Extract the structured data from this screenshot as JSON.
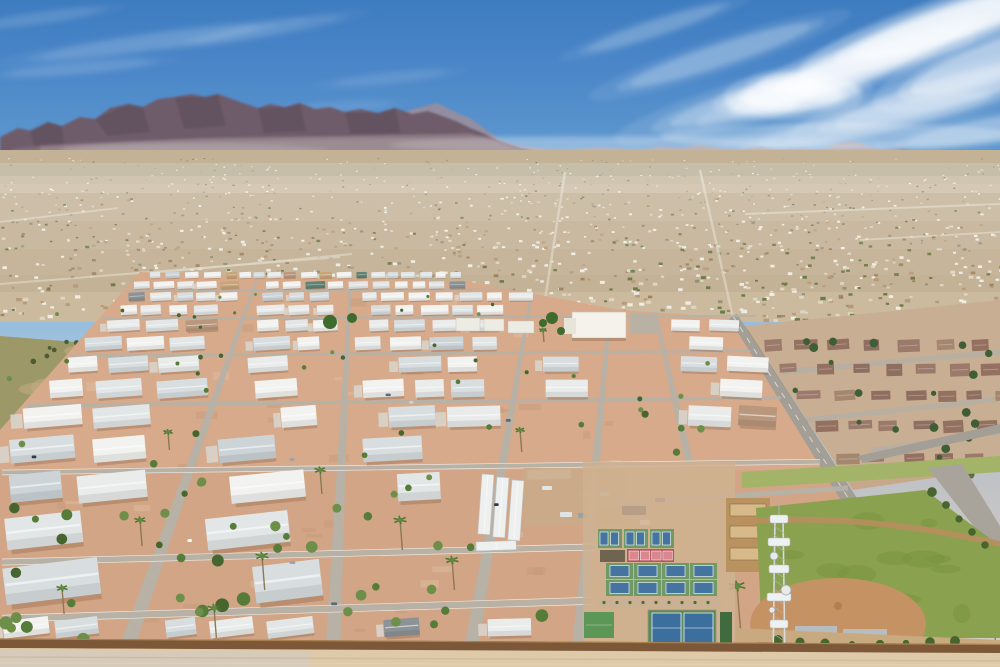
{
  "meta": {
    "width": 1000,
    "height": 667,
    "seed": 1317,
    "scene": "aerial-desert-mobile-home-park",
    "horizon_y": 168
  },
  "palette": {
    "sky_top": "#3e7cc0",
    "sky_horizon": "#dde2e2",
    "cloud": "#ffffff",
    "mountain_far": "#9e8e99",
    "mountain_main": "#6f5c6a",
    "mountain_facet": "#584a58",
    "mountain_base": "#8a7880",
    "city_base": "#c3b296",
    "city_light": "#cdbb9f",
    "park_dirt": "#d6aa8b",
    "street": "#b6b1a8",
    "street_edge": "#f2efe8",
    "roof_white": "#eef0ef",
    "wall_brown": "#7c5838",
    "grass": "#86a04f",
    "infield": "#c59263",
    "court_green": "#6f9a66",
    "court_blue": "#44749f",
    "court_pink": "#d98890",
    "court_red": "#b5525c",
    "road_gray": "#a39e96",
    "neighborhood_roof": "#977666",
    "bottom_dirt": "#decaa9"
  },
  "clouds": {
    "back": [
      [
        655,
        28,
        70,
        7,
        -18,
        0.2
      ],
      [
        720,
        55,
        95,
        10,
        -18,
        0.28
      ],
      [
        795,
        88,
        130,
        14,
        -16,
        0.36
      ],
      [
        860,
        65,
        120,
        13,
        -20,
        0.44
      ],
      [
        915,
        38,
        130,
        15,
        -20,
        0.58
      ],
      [
        965,
        18,
        120,
        16,
        -18,
        0.75
      ],
      [
        995,
        60,
        90,
        18,
        -20,
        0.55
      ],
      [
        940,
        95,
        110,
        14,
        -16,
        0.4
      ],
      [
        875,
        120,
        120,
        12,
        -12,
        0.3
      ],
      [
        985,
        130,
        80,
        10,
        -10,
        0.33
      ],
      [
        793,
        96,
        48,
        14,
        0,
        0.65
      ],
      [
        762,
        104,
        34,
        10,
        0,
        0.52
      ],
      [
        824,
        90,
        34,
        11,
        0,
        0.48
      ],
      [
        790,
        84,
        30,
        9,
        0,
        0.42
      ],
      [
        150,
        42,
        110,
        7,
        -8,
        0.15
      ],
      [
        80,
        68,
        70,
        5,
        -5,
        0.12
      ],
      [
        265,
        30,
        75,
        6,
        -10,
        0.11
      ],
      [
        390,
        78,
        55,
        5,
        -6,
        0.09
      ],
      [
        40,
        18,
        60,
        5,
        -8,
        0.11
      ],
      [
        330,
        108,
        60,
        5,
        -4,
        0.07
      ]
    ],
    "haze": [
      [
        480,
        150,
        420,
        13,
        0,
        0.2
      ],
      [
        840,
        136,
        180,
        13,
        0,
        0.26
      ],
      [
        170,
        152,
        160,
        9,
        0,
        0.14
      ],
      [
        650,
        145,
        260,
        10,
        0,
        0.16
      ]
    ]
  },
  "mountains": {
    "far": "380,122 410,110 437,103 455,112 470,118 500,140 520,146 560,150 600,147 640,150 660,146 680,148 700,144 720,148 740,150 760,146 780,150 800,148 820,150 838,143 852,141 865,145 880,150 900,148 915,151 930,153 950,151 970,154 1000,152 1000,168 380,168",
    "main": "0,137 18,128 32,131 48,122 62,126 80,117 95,119 110,108 128,104 143,107 158,99 175,97 192,94 205,97 218,94 232,99 246,104 258,108 270,104 285,107 300,103 315,109 330,107 345,112 360,109 378,113 395,108 412,114 428,111 445,117 458,122 470,128 485,134 500,141 520,148 545,154 545,168 0,168",
    "facets": [
      "95,119 128,104 143,107 150,132 108,136",
      "175,97 205,97 218,94 226,126 184,129",
      "258,108 285,107 300,103 306,131 264,133",
      "345,112 378,113 395,108 401,133 350,134",
      "30,130 48,122 62,126 64,144 34,146"
    ],
    "base": "40,146 200,138 340,136 470,133 520,150 545,160 545,168 40,168"
  },
  "city": {
    "top": 150,
    "bottom": 322,
    "olive_bands": [
      [
        163,
        13,
        0.4,
        "#8f8c6a"
      ],
      [
        176,
        8,
        0.22,
        "#9b947a"
      ]
    ],
    "atmo": [
      [
        163,
        30,
        0.3
      ],
      [
        193,
        28,
        0.17
      ],
      [
        221,
        28,
        0.1
      ],
      [
        249,
        26,
        0.05
      ]
    ],
    "speckles": {
      "count": 1450,
      "colors": [
        [
          "#efece2",
          30
        ],
        [
          "#dfd5c1",
          22
        ],
        [
          "#b89a78",
          16
        ],
        [
          "#a08462",
          10
        ],
        [
          "#6e7c48",
          14
        ],
        [
          "#93907c",
          8
        ]
      ]
    },
    "roads": [
      [
        565,
        172,
        545,
        300,
        2.5
      ],
      [
        700,
        170,
        733,
        318,
        2.5
      ],
      [
        352,
        254,
        142,
        274,
        2
      ],
      [
        0,
        284,
        340,
        257,
        2
      ],
      [
        745,
        214,
        1000,
        204,
        2
      ],
      [
        118,
        208,
        0,
        222,
        1.8
      ],
      [
        860,
        240,
        1000,
        232,
        1.8
      ]
    ]
  },
  "vacant_lot": {
    "poly": "0,336 152,348 118,432 0,452",
    "color": "#9d9868",
    "patch": "#c2ab82",
    "tree_color": "#4c5c33",
    "trees": 13
  },
  "neighborhood": {
    "poly": "745,326 1000,300 1000,468 853,490",
    "base": "#c8ae92",
    "roofs": [
      "#9b7a6b",
      "#8d6e60",
      "#a5876f",
      "#93705f"
    ],
    "rows": [
      340,
      364,
      391,
      421,
      454
    ],
    "tree_color": "#3f5e35",
    "trees": 26,
    "roads": [
      [
        782,
        372,
        1000,
        352,
        5
      ],
      [
        806,
        420,
        1000,
        399,
        5
      ],
      [
        872,
        450,
        1000,
        432,
        4
      ]
    ],
    "wall_color": "#8a6a4e"
  },
  "main_road": {
    "pts": [
      733,
      316,
      955,
      667
    ],
    "w_top": 9,
    "w_bot": 20,
    "color": "#a39e96",
    "branch": "858,456 1000,424 1000,433 863,463"
  },
  "park": {
    "poly": "140,272 470,282 620,310 733,318 955,667 0,667 0,430",
    "vp": [
      565,
      248
    ],
    "dirt": "#d6aa8b",
    "dirt_dark": "#c49877",
    "left_bound": [
      140,
      272,
      0,
      430
    ],
    "top_right": [
      470,
      282,
      733,
      318
    ],
    "rows": {
      "y0": 272,
      "h0": 6.2,
      "growth": 1.16,
      "gap": 1.52,
      "max_y": 638
    },
    "roof_colors": [
      [
        "#f2f3f1",
        26
      ],
      [
        "#e9eceb",
        22
      ],
      [
        "#e2e6e7",
        16
      ],
      [
        "#d8dee0",
        12
      ],
      [
        "#cdd4d8",
        8
      ],
      [
        "#c8a477",
        3
      ],
      [
        "#5f8273",
        2
      ],
      [
        "#8c9296",
        3
      ],
      [
        "#b9977c",
        2
      ]
    ],
    "radial_streets": [
      [
        258,
        276,
        120,
        667
      ],
      [
        350,
        282,
        332,
        667
      ],
      [
        530,
        302,
        468,
        667
      ],
      [
        610,
        310,
        577,
        667
      ],
      [
        655,
        312,
        690,
        466
      ]
    ],
    "cross_streets": [
      290,
      317,
      353,
      401,
      466,
      553,
      608
    ],
    "extra_streets": [
      [
        598,
        505,
        848,
        488,
        5.5
      ]
    ],
    "shrubs": {
      "count": 95,
      "colors": [
        "#567c39",
        "#47662f",
        "#6d8f4a"
      ]
    },
    "palms": [
      [
        988,
        548,
        10,
        92
      ],
      [
        944,
        590,
        8,
        48
      ],
      [
        737,
        586,
        9,
        54
      ],
      [
        400,
        520,
        7,
        30
      ],
      [
        262,
        556,
        7,
        34
      ],
      [
        140,
        520,
        6,
        26
      ],
      [
        520,
        430,
        5,
        22
      ],
      [
        320,
        470,
        6,
        24
      ],
      [
        600,
        472,
        5,
        20
      ],
      [
        214,
        608,
        7,
        30
      ],
      [
        62,
        588,
        6,
        26
      ],
      [
        452,
        560,
        7,
        30
      ],
      [
        543,
        330,
        4,
        12
      ],
      [
        168,
        432,
        5,
        18
      ]
    ],
    "exclusions": [
      [
        583,
        462,
        154,
        192
      ],
      [
        476,
        466,
        150,
        82
      ],
      [
        548,
        304,
        118,
        40
      ],
      [
        726,
        455,
        274,
        212
      ]
    ]
  },
  "clubhouse": {
    "main": [
      572,
      312,
      54,
      26
    ],
    "wing": [
      564,
      318,
      12,
      16
    ],
    "roof": "#f4f2ea",
    "parking": [
      630,
      314,
      28,
      20
    ],
    "outbuildings": [
      [
        456,
        318,
        24,
        13
      ],
      [
        484,
        319,
        20,
        12
      ],
      [
        508,
        321,
        26,
        12
      ]
    ],
    "trees": [
      [
        552,
        318,
        6
      ],
      [
        561,
        331,
        4
      ],
      [
        543,
        323,
        4
      ],
      [
        330,
        322,
        7
      ],
      [
        352,
        318,
        5
      ]
    ]
  },
  "storage": {
    "color": "#eef0ef",
    "sheds": [
      [
        482,
        474,
        12,
        60,
        4
      ],
      [
        497,
        477,
        12,
        60,
        4
      ],
      [
        512,
        480,
        12,
        60,
        4
      ],
      [
        527,
        470,
        44,
        10,
        -2
      ],
      [
        476,
        542,
        40,
        9,
        -2
      ]
    ]
  },
  "parking_lot": {
    "rect": [
      524,
      468,
      102,
      58
    ],
    "color": "#c9ab89",
    "vehicles": [
      [
        622,
        506,
        24,
        9,
        "#2c3a4d"
      ],
      [
        560,
        512,
        12,
        5,
        "#dfe3e6"
      ],
      [
        578,
        513,
        10,
        5,
        "#9aa2a8"
      ],
      [
        640,
        520,
        10,
        5,
        "#e8e8e6"
      ],
      [
        600,
        492,
        9,
        4,
        "#c2c6c9"
      ],
      [
        655,
        498,
        10,
        4,
        "#6b7580"
      ],
      [
        542,
        486,
        10,
        4,
        "#e4e6e6"
      ]
    ]
  },
  "sports": {
    "apron": [
      583,
      462,
      152,
      190
    ],
    "apron_color": "#cfb191",
    "upper_courts": {
      "x": 598,
      "y": 529,
      "w": 24,
      "h": 19,
      "n": 3,
      "gap": 2
    },
    "bleachers": [
      600,
      550,
      25,
      12,
      "#6f6450"
    ],
    "pink_base": [
      627,
      549,
      47,
      13
    ],
    "pink_courts": 4,
    "main_courts": {
      "x": 606,
      "y": 563,
      "w": 27,
      "h": 16,
      "cols": 4,
      "rows": 2,
      "gapx": 1,
      "gapy": 1
    },
    "walkway": [
      598,
      597,
      124,
      11,
      "#cbb193"
    ],
    "tennis": {
      "outer": [
        648,
        610,
        68,
        36
      ],
      "courts": [
        [
          652,
          613,
          29,
          30
        ],
        [
          684,
          613,
          29,
          30
        ]
      ]
    },
    "green_building": [
      584,
      612,
      30,
      26,
      "#5d9758"
    ],
    "hedge_strip": [
      720,
      612,
      12,
      34,
      "#3f6b3f"
    ],
    "batting": [
      726,
      498,
      44,
      74,
      "#b9935f"
    ],
    "fence": "#9a958c"
  },
  "ballpark": {
    "upper_strip": "742,472 1000,456 1000,472 742,488",
    "upper_color": "#a3b368",
    "gray_road": "928,468 962,464 1000,526 1000,560",
    "grass": "756,508 925,490 1000,546 1000,638 762,638",
    "grass_hi": "#8aa24f",
    "grass_lo": "#77923e",
    "track": "M740,522 Q860,512 1000,544",
    "track_color": "#bb8d5e",
    "infield": [
      838,
      624,
      88,
      46
    ],
    "dugouts": [
      [
        795,
        626,
        42,
        10
      ],
      [
        843,
        629,
        44,
        10
      ]
    ],
    "dugout_color": "#b7bcc0",
    "walkway": "735,628 1000,640 1000,650 735,641",
    "walkway_color": "#c9aa80",
    "bushes": [
      [
        778,
        640
      ],
      [
        800,
        642
      ],
      [
        825,
        643
      ],
      [
        852,
        644
      ],
      [
        880,
        644
      ],
      [
        906,
        643
      ],
      [
        930,
        642
      ],
      [
        955,
        641
      ],
      [
        932,
        492
      ],
      [
        946,
        505
      ],
      [
        959,
        519
      ],
      [
        972,
        532
      ],
      [
        985,
        545
      ]
    ],
    "bush_color": "#46652f"
  },
  "tower": {
    "x": 779,
    "top": 507,
    "leg_off": 4,
    "bot": 667,
    "metal": "#d8dadc",
    "dark": "#aeb2b6",
    "clusters": [
      [
        515,
        18
      ],
      [
        538,
        22
      ],
      [
        565,
        20
      ],
      [
        593,
        24
      ],
      [
        620,
        18
      ],
      [
        645,
        16
      ]
    ],
    "dishes": [
      [
        774,
        556,
        4
      ],
      [
        786,
        590,
        5
      ],
      [
        772,
        610,
        3
      ]
    ]
  },
  "wall": {
    "poly": "0,638.5 1000,644 1000,654 0,648",
    "color": "#7c5838",
    "hi": "#a8804f"
  },
  "bottom": {
    "poly": "0,648 1000,653 1000,667 0,667",
    "color": "#decaa9",
    "pavement": "0,650 310,652 310,667 0,667",
    "pavement_color": "#d5cbbb"
  },
  "cars": {
    "count": 9,
    "colors": [
      "#ffffff",
      "#2f3a4a",
      "#98a0a6",
      "#5b6b7b",
      "#d8d2c6"
    ]
  },
  "labels": {
    "alt_text": ""
  }
}
